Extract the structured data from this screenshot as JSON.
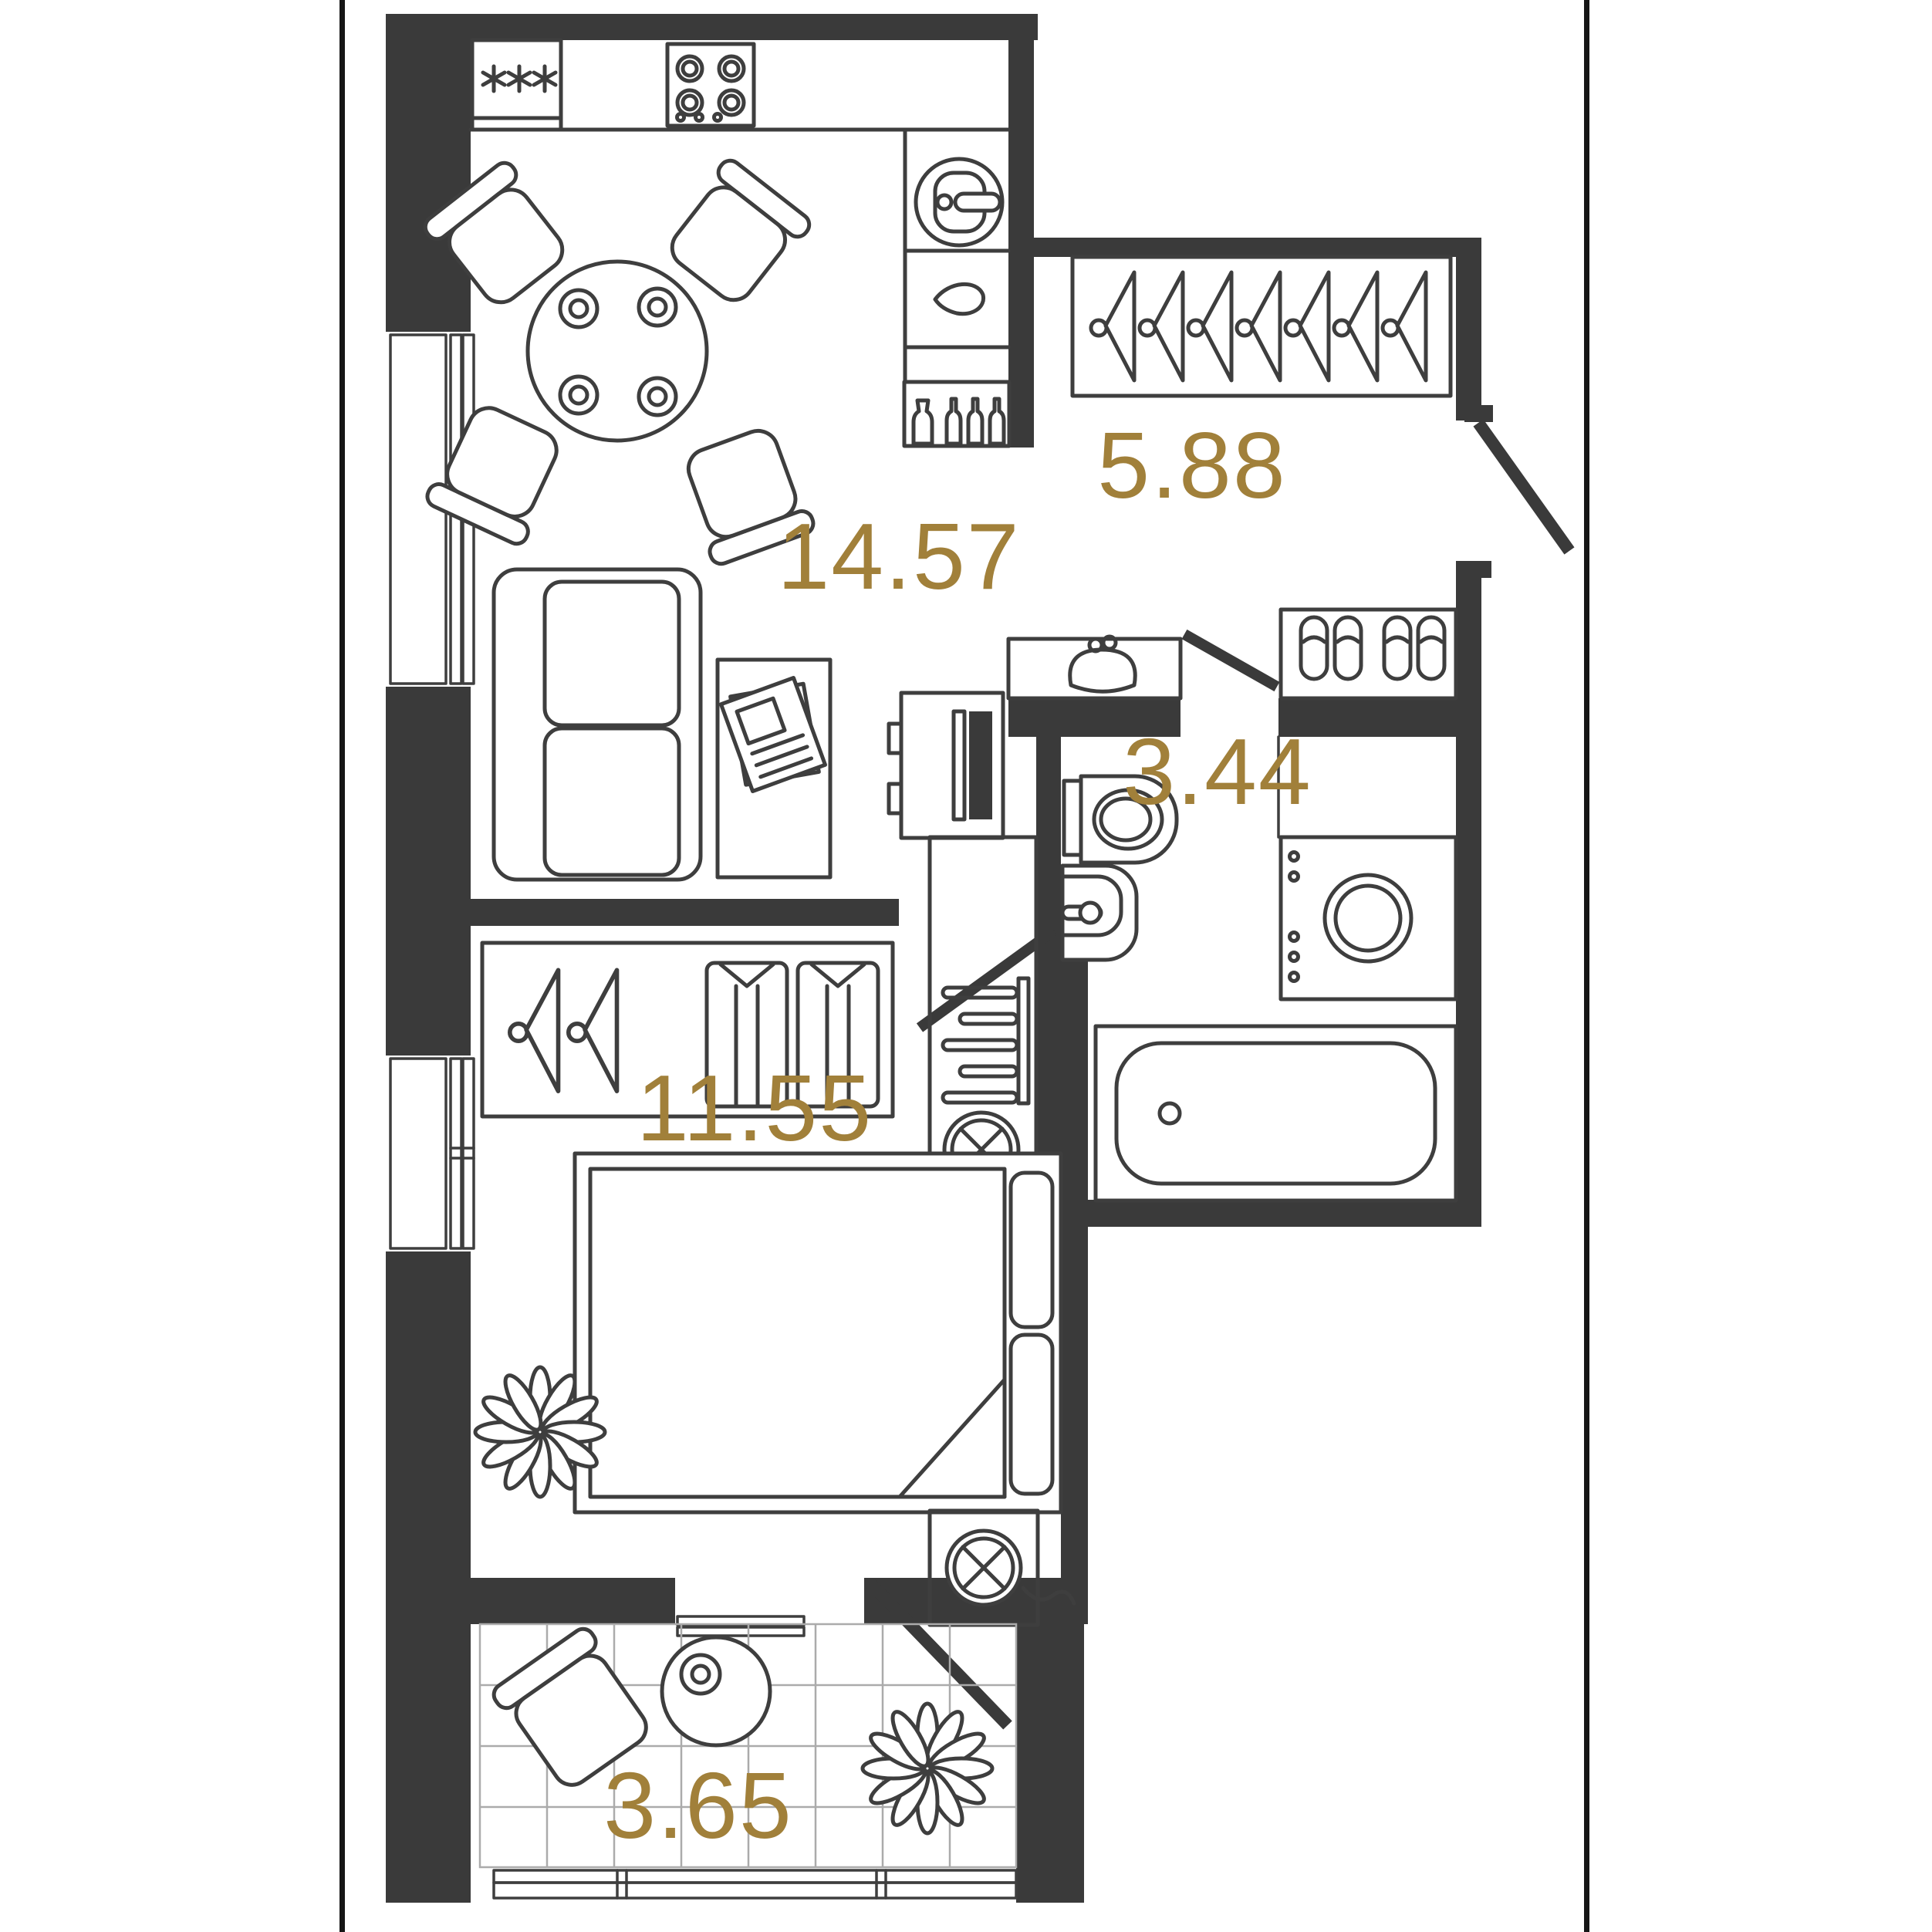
{
  "plan": {
    "type": "apartment-floor-plan",
    "rooms": [
      {
        "name": "kitchen-living-room",
        "area": "14.57"
      },
      {
        "name": "hallway",
        "area": "5.88"
      },
      {
        "name": "bathroom",
        "area": "3.44"
      },
      {
        "name": "bedroom",
        "area": "11.55"
      },
      {
        "name": "balcony",
        "area": "3.65"
      }
    ],
    "colors": {
      "walls": "#3a3a3a",
      "fixtures_stroke": "#3e3e3e",
      "area_labels": "#a1803a",
      "tile_grid": "#ababab",
      "background": "#ffffff"
    }
  }
}
